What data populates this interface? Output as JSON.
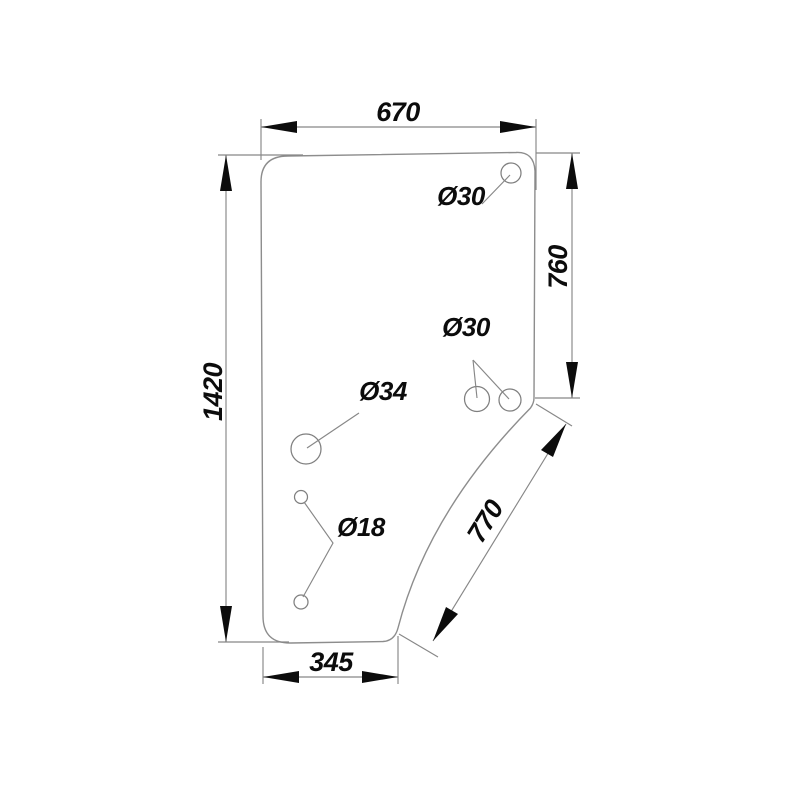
{
  "drawing": {
    "kind": "technical-dimension-drawing",
    "dimensions": {
      "top_width": "670",
      "left_height": "1420",
      "right_height": "760",
      "diagonal_edge": "770",
      "bottom_width": "345"
    },
    "hole_labels": {
      "top_right": "Ø30",
      "mid_right_pair": "Ø30",
      "mid_left": "Ø34",
      "lower_left_pair": "Ø18"
    },
    "colors": {
      "background": "#ffffff",
      "line": "#8d8d8d",
      "ink": "#0c0c0c"
    }
  }
}
